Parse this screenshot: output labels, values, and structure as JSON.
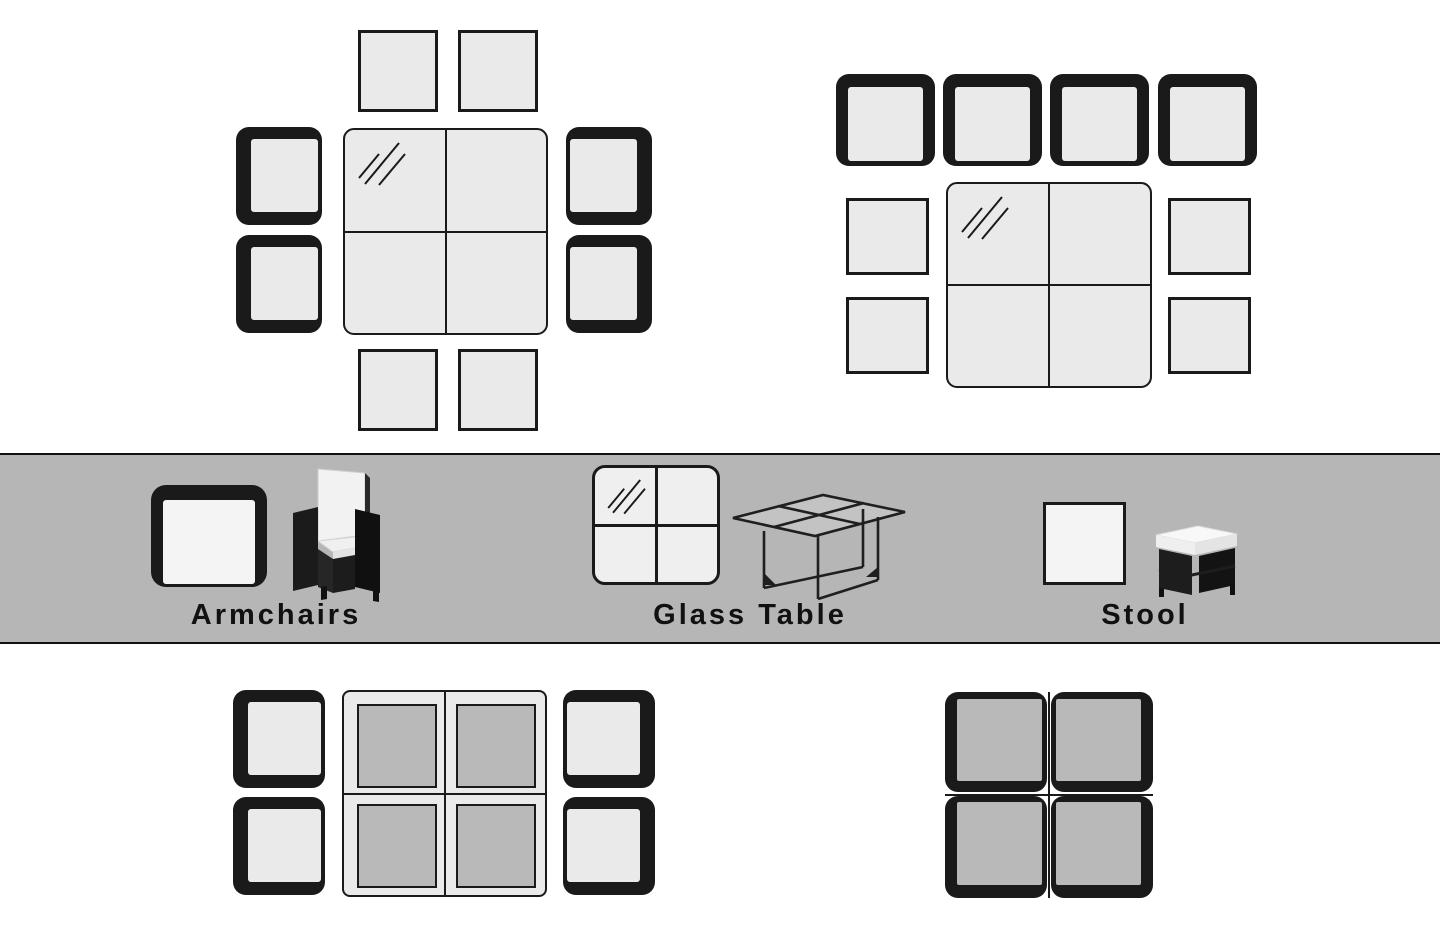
{
  "legend": {
    "items": [
      {
        "id": "armchair",
        "label": "Armchairs"
      },
      {
        "id": "glass-table",
        "label": "Glass Table"
      },
      {
        "id": "stool",
        "label": "Stool"
      }
    ]
  },
  "layouts": [
    {
      "id": "top-left",
      "armchairs": 4,
      "stools": 4,
      "glass_tables": 1,
      "arrangement": "armchairs on left and right sides, stools above and below table"
    },
    {
      "id": "top-right",
      "armchairs": 4,
      "stools": 4,
      "glass_tables": 1,
      "arrangement": "armchairs in a row above, stools on left and right of table"
    },
    {
      "id": "bottom-left",
      "armchairs": 4,
      "stools": 4,
      "glass_tables": 1,
      "arrangement": "stools tucked under table, armchairs on left and right"
    },
    {
      "id": "bottom-right",
      "armchairs": 4,
      "stools": 4,
      "glass_tables": 1,
      "arrangement": "fully nested cube, chairs pushed together over table"
    }
  ],
  "colors": {
    "background": "#ffffff",
    "band": "#b6b6b6",
    "outline": "#1a1a1a",
    "furniture_light": "#eaeaea",
    "furniture_mid": "#b9b9b9",
    "legend_fill": "#f4f4f4"
  }
}
